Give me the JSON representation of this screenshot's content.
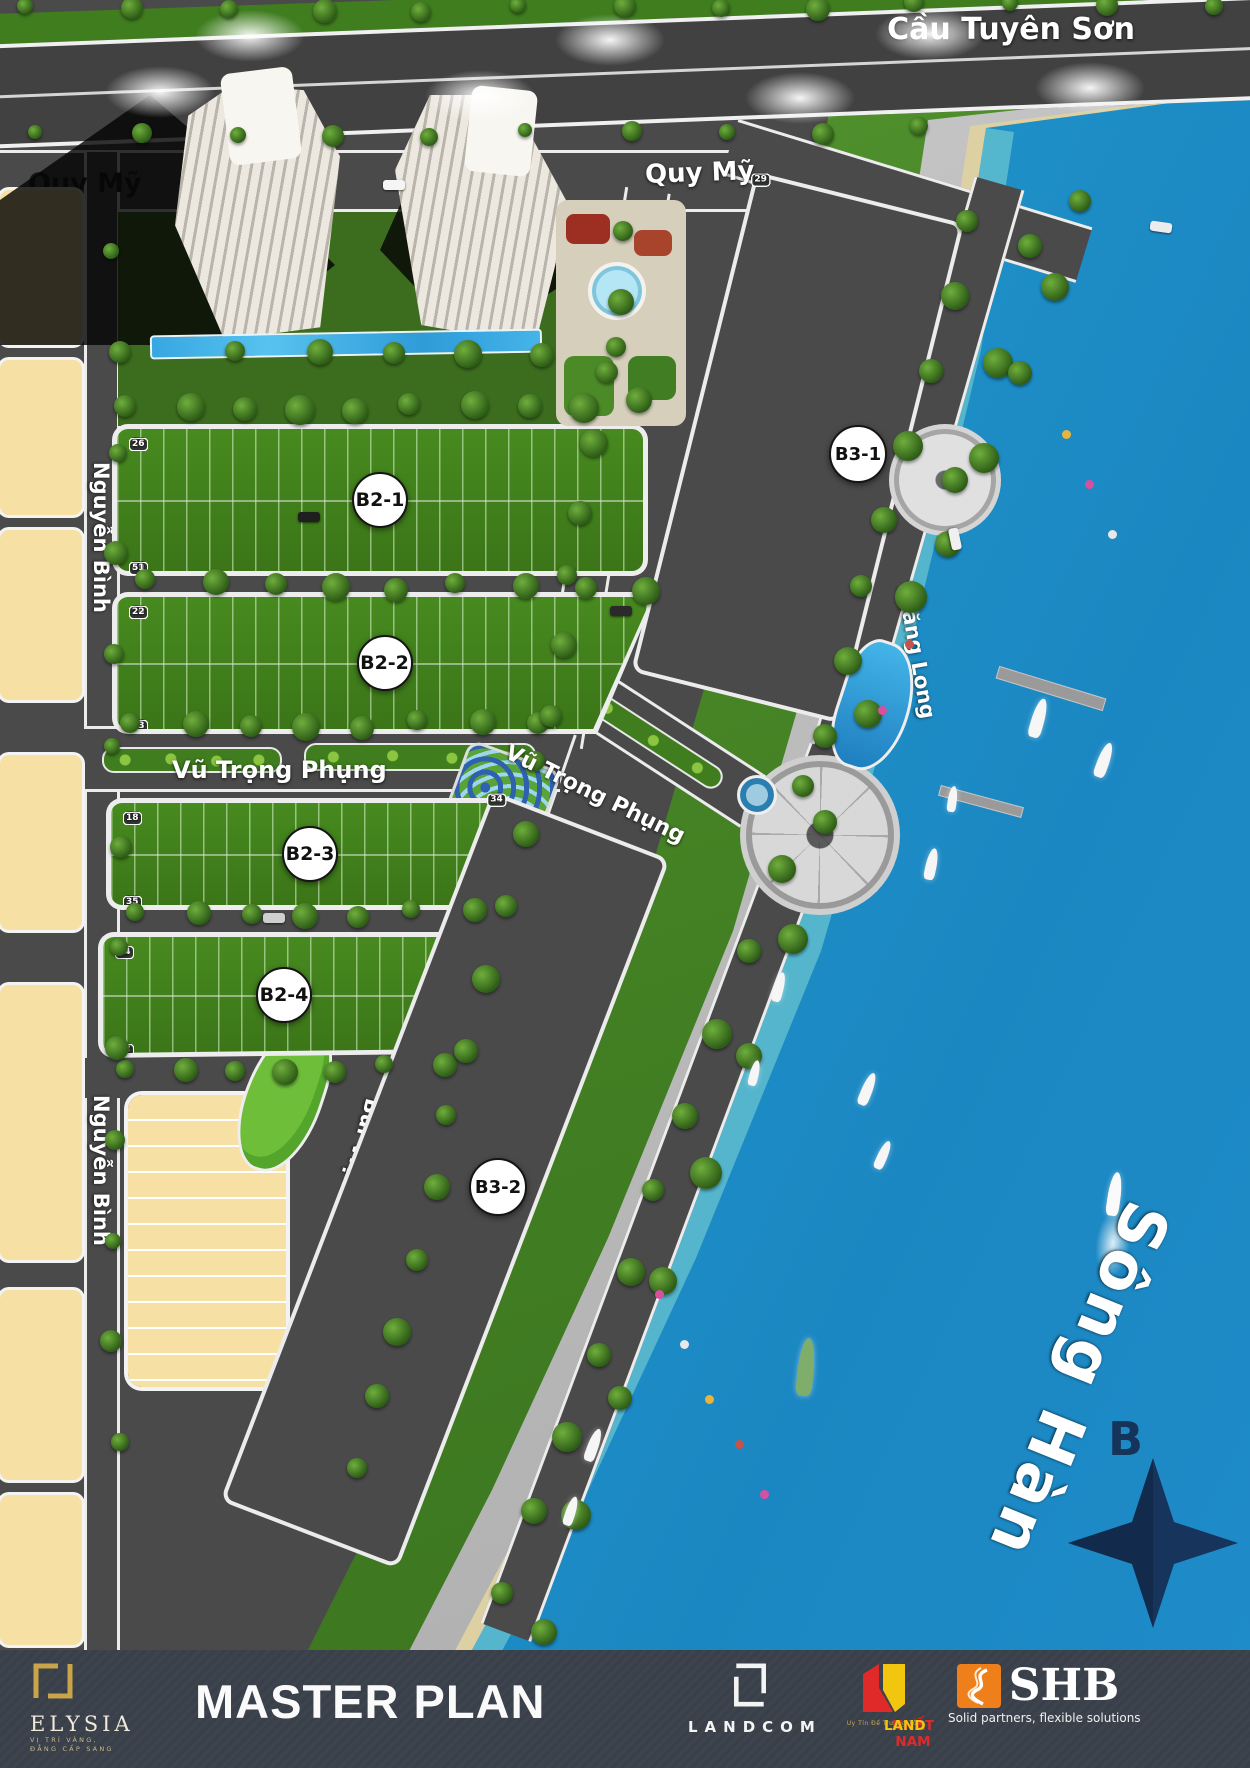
{
  "map": {
    "bridge_label": "Cầu Tuyên Sơn",
    "streets": {
      "quy_my": "Quy Mỹ",
      "bui_vien": "Bùi Viện",
      "nguyen_binh": "Nguyễn Bình",
      "vu_trong_phung": "Vũ Trọng Phụng",
      "thang_long": "Thăng Long"
    },
    "river_label": "Sông Hàn",
    "compass_label": "B",
    "blocks": [
      {
        "id": "B2-1",
        "label": "B2-1",
        "top_row": [
          "1",
          "3",
          "4",
          "5",
          "6",
          "7",
          "8",
          "9",
          "10",
          "11",
          "12",
          "13",
          "14",
          "15",
          "16",
          "17",
          "18",
          "19",
          "20",
          "21",
          "22",
          "23",
          "24",
          "26"
        ],
        "bottom_row": [
          "27",
          "29",
          "30",
          "31",
          "32",
          "33",
          "34",
          "35",
          "36",
          "37",
          "38",
          "39",
          "40",
          "41",
          "42",
          "43",
          "44",
          "45",
          "46",
          "47",
          "48",
          "49",
          "51"
        ]
      },
      {
        "id": "B2-2",
        "label": "B2-2",
        "top_row": [
          "1",
          "3",
          "4",
          "5",
          "6",
          "7",
          "8",
          "9",
          "10",
          "11",
          "12",
          "13",
          "14",
          "15",
          "16",
          "17",
          "18",
          "19",
          "20",
          "22"
        ],
        "bottom_row": [
          "23",
          "25",
          "26",
          "27",
          "28",
          "29",
          "30",
          "31",
          "32",
          "33",
          "34",
          "35",
          "36",
          "37",
          "38",
          "39",
          "40",
          "41",
          "43"
        ]
      },
      {
        "id": "B2-3",
        "label": "B2-3",
        "top_row": [
          "1",
          "3",
          "4",
          "5",
          "6",
          "7",
          "8",
          "9",
          "10",
          "11",
          "12",
          "13",
          "14",
          "15",
          "16",
          "18"
        ],
        "bottom_row": [
          "19",
          "21",
          "22",
          "23",
          "24",
          "25",
          "26",
          "27",
          "28",
          "29",
          "30",
          "31",
          "32",
          "33",
          "35"
        ]
      },
      {
        "id": "B2-4",
        "label": "B2-4",
        "top_row": [
          "1",
          "3",
          "4",
          "5",
          "6",
          "7",
          "8",
          "9",
          "10",
          "11",
          "12",
          "14"
        ],
        "bottom_row": [
          "15",
          "17",
          "18",
          "19",
          "20",
          "21",
          "22",
          "23",
          "24",
          "25",
          "27"
        ]
      }
    ],
    "villa_rows": [
      {
        "id": "B3-1",
        "label": "B3-1",
        "west": [
          "1",
          "3",
          "4",
          "5",
          "6",
          "7",
          "8",
          "9",
          "10",
          "11",
          "12",
          "14",
          "16"
        ],
        "east": [
          "15",
          "17",
          "18",
          "19",
          "20",
          "21",
          "22",
          "23",
          "24",
          "25",
          "26",
          "27",
          "28",
          "29"
        ]
      },
      {
        "id": "B3-2",
        "label": "B3-2",
        "west": [
          "1",
          "3",
          "4",
          "5",
          "6",
          "7",
          "8",
          "9",
          "10",
          "11",
          "12",
          "13",
          "14",
          "15",
          "16"
        ],
        "east": [
          "17",
          "18",
          "19",
          "20",
          "21",
          "22",
          "23",
          "24",
          "25",
          "26",
          "27",
          "28",
          "29",
          "30",
          "31",
          "32",
          "33",
          "34"
        ]
      }
    ]
  },
  "footer": {
    "title": "MASTER PLAN",
    "elysia": {
      "name": "ELYSIA",
      "tagline1": "VỊ TRÍ VÀNG,",
      "tagline2": "ĐẲNG CẤP SANG"
    },
    "landcom": {
      "name": "LANDCOM"
    },
    "nhat_nam": {
      "name_primary": "NHẤT NAM",
      "name_secondary": " LAND",
      "tagline": "Uy Tín Để Trường Tồn"
    },
    "shb": {
      "name": "SHB",
      "tagline": "Solid partners, flexible solutions"
    }
  },
  "colors": {
    "road": "#4a4a4a",
    "grass": "#3f7d1f",
    "water": "#2196cb",
    "lot_tan": "#f6e0a3",
    "footer_bg": "#394049",
    "accent_gold": "#c9a54a",
    "shb_orange": "#ef7f1a",
    "nhatnam_red": "#e02a2a",
    "nhatnam_yellow": "#f2c50f"
  }
}
